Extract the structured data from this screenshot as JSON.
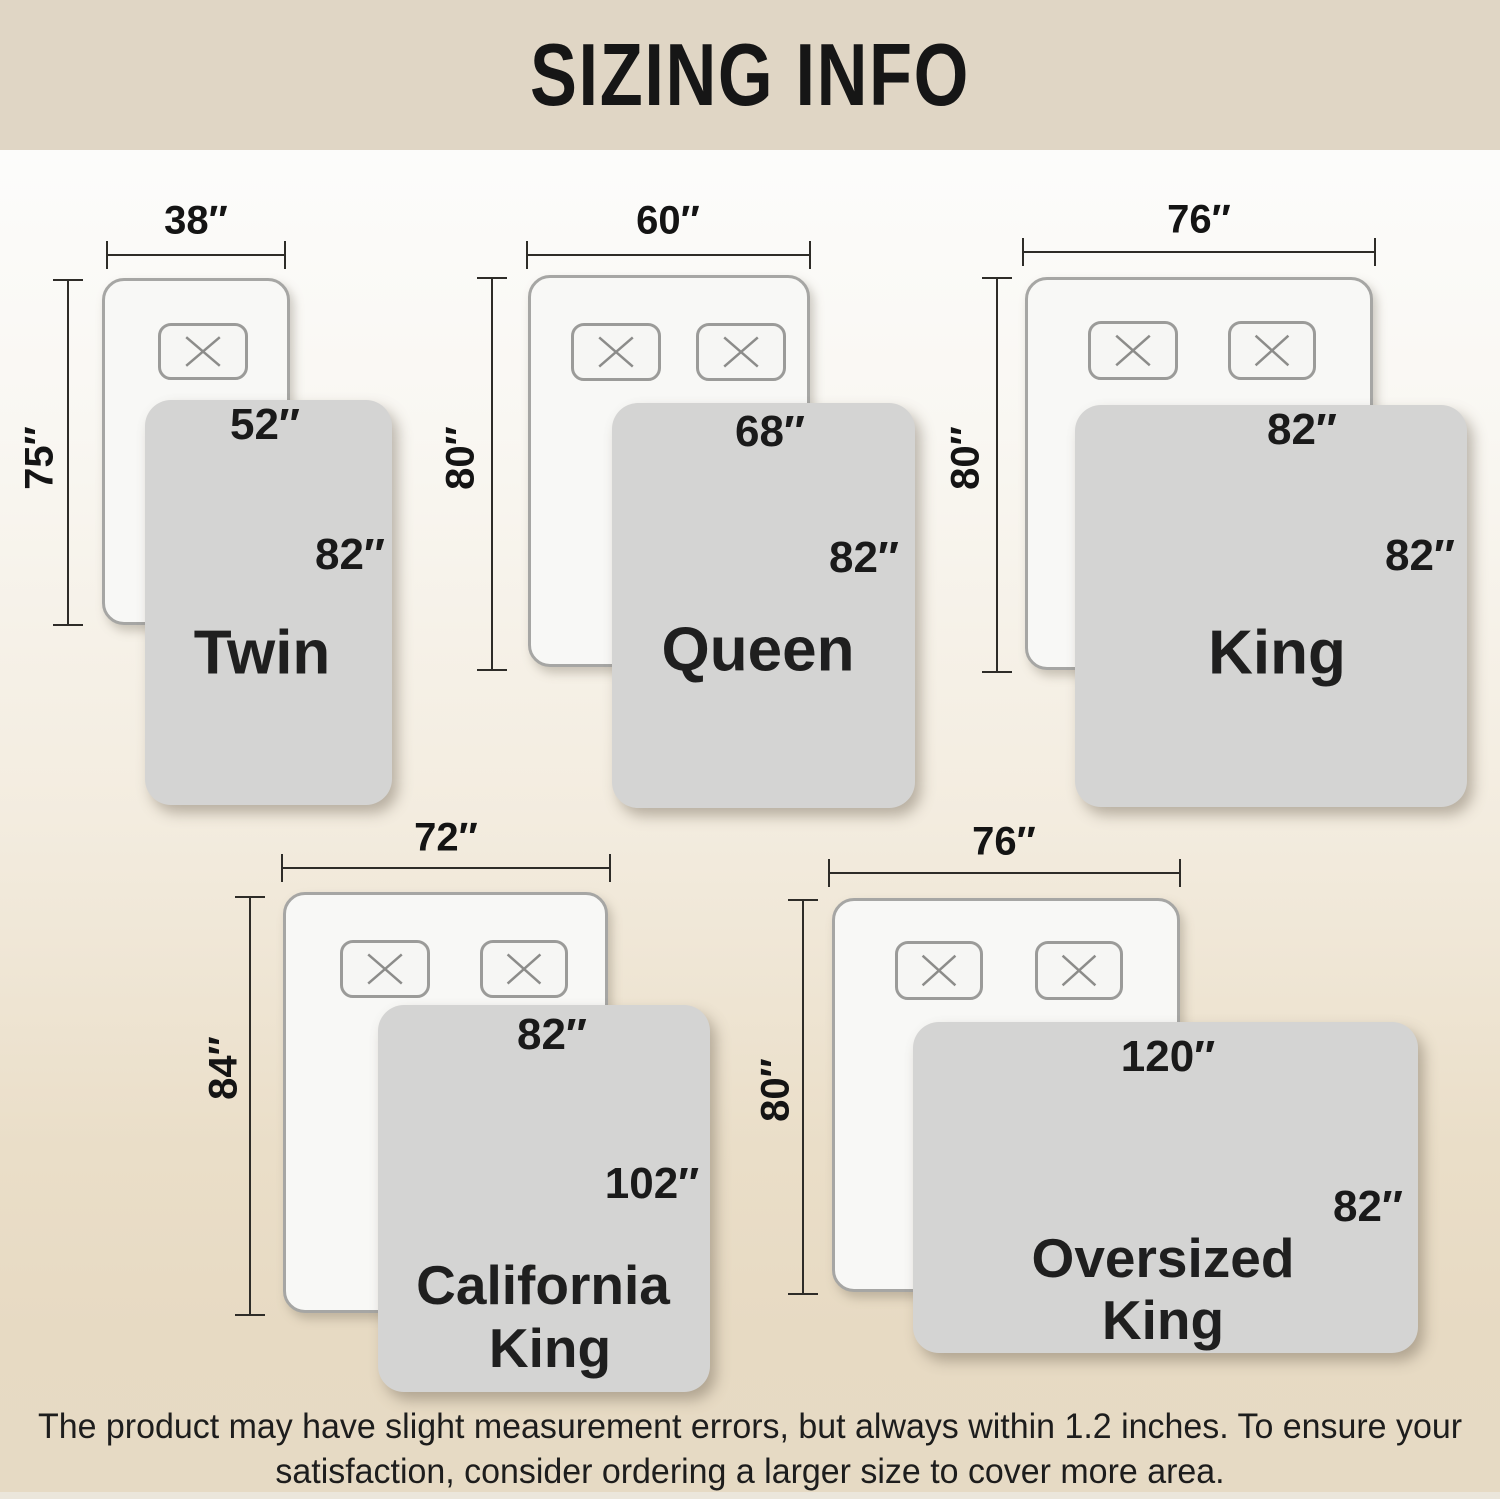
{
  "header": {
    "title": "SIZING INFO"
  },
  "footer": {
    "line1": "The product may have slight measurement errors, but always within 1.2 inches. To ensure your",
    "line2": "satisfaction, consider ordering a larger size to cover more area."
  },
  "colors": {
    "header_band": "#e0d6c5",
    "bed_fill": "#f8f8f6",
    "bed_border": "#a6a6a4",
    "blanket_fill": "#d4d4d3",
    "dimension_line": "#2e2c28",
    "text": "#141414"
  },
  "groups": [
    {
      "id": "twin",
      "name": "Twin",
      "name_lines": [
        "Twin"
      ],
      "bed_width": "38″",
      "bed_length": "75″",
      "blanket_width": "52″",
      "blanket_length": "82″",
      "pillow_count": 1
    },
    {
      "id": "queen",
      "name": "Queen",
      "name_lines": [
        "Queen"
      ],
      "bed_width": "60″",
      "bed_length": "80″",
      "blanket_width": "68″",
      "blanket_length": "82″",
      "pillow_count": 2
    },
    {
      "id": "king",
      "name": "King",
      "name_lines": [
        "King"
      ],
      "bed_width": "76″",
      "bed_length": "80″",
      "blanket_width": "82″",
      "blanket_length": "82″",
      "pillow_count": 2
    },
    {
      "id": "california-king",
      "name": "California King",
      "name_lines": [
        "California",
        "King"
      ],
      "bed_width": "72″",
      "bed_length": "84″",
      "blanket_width": "82″",
      "blanket_length": "102″",
      "pillow_count": 2
    },
    {
      "id": "oversized-king",
      "name": "Oversized King",
      "name_lines": [
        "Oversized",
        "King"
      ],
      "bed_width": "76″",
      "bed_length": "80″",
      "blanket_width": "120″",
      "blanket_length": "82″",
      "pillow_count": 2
    }
  ]
}
